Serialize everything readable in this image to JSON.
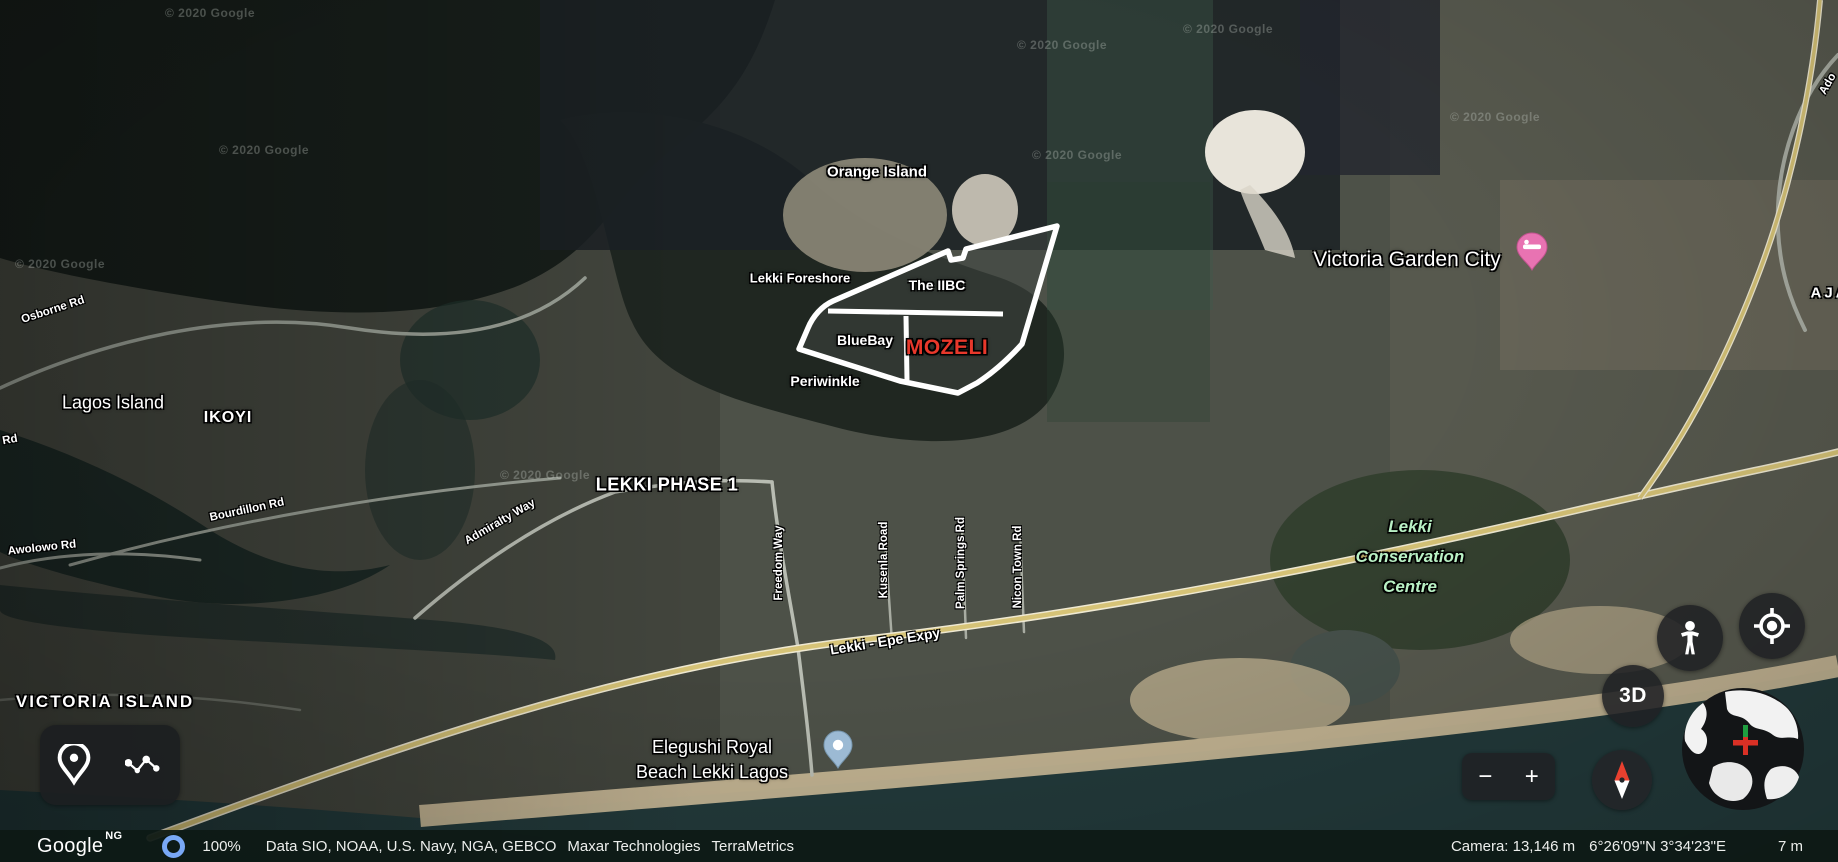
{
  "statusbar": {
    "logo": "Google",
    "region": "NG",
    "progress": "100%",
    "attribution_1": "Data SIO, NOAA, U.S. Navy, NGA, GEBCO",
    "attribution_2": "Maxar Technologies",
    "attribution_3": "TerraMetrics",
    "camera_altitude": "Camera: 13,146 m",
    "coordinates": "6°26'09\"N 3°34'23\"E",
    "elevation": "7 m"
  },
  "controls": {
    "threed_label": "3D",
    "zoom_out_label": "−",
    "zoom_in_label": "+"
  },
  "map": {
    "place_labels": [
      {
        "id": "label-orange-island",
        "text": "Orange Island",
        "x": 877,
        "y": 172,
        "size": 15,
        "weight": 600
      },
      {
        "id": "label-lekki-foreshore",
        "text": "Lekki Foreshore",
        "x": 800,
        "y": 278,
        "size": 13,
        "weight": 600
      },
      {
        "id": "label-the-iibc",
        "text": "The IIBC",
        "x": 937,
        "y": 285,
        "size": 14,
        "weight": 600
      },
      {
        "id": "label-bluebay",
        "text": "BlueBay",
        "x": 865,
        "y": 340,
        "size": 14,
        "weight": 600
      },
      {
        "id": "label-mozeli",
        "text": "MOZELI",
        "x": 947,
        "y": 348,
        "size": 21,
        "weight": 800,
        "color": "#e8382b",
        "ls": 0.5
      },
      {
        "id": "label-periwinkle",
        "text": "Periwinkle",
        "x": 825,
        "y": 381,
        "size": 14,
        "weight": 600
      },
      {
        "id": "label-lagos-island",
        "text": "Lagos Island",
        "x": 113,
        "y": 403,
        "size": 18,
        "weight": 400
      },
      {
        "id": "label-ikoyi",
        "text": "IKOYI",
        "x": 228,
        "y": 418,
        "size": 16,
        "weight": 700,
        "ls": 1
      },
      {
        "id": "label-lekki-phase-1",
        "text": "LEKKI PHASE 1",
        "x": 667,
        "y": 485,
        "size": 18,
        "weight": 700,
        "ls": 0.5
      },
      {
        "id": "label-victoria-island",
        "text": "VICTORIA ISLAND",
        "x": 105,
        "y": 702,
        "size": 17,
        "weight": 700,
        "ls": 2
      },
      {
        "id": "label-victoria-garden-city",
        "text": "Victoria Garden City",
        "x": 1407,
        "y": 260,
        "size": 21,
        "weight": 500
      },
      {
        "id": "label-lekki-conservation-centre",
        "lines": [
          "Lekki",
          "Conservation",
          "Centre"
        ],
        "x": 1410,
        "y": 557,
        "size": 17,
        "weight": 600,
        "italic": true,
        "color": "#b9f0c4",
        "lh": 30
      },
      {
        "id": "label-elegushi-royal-beach",
        "lines": [
          "Elegushi Royal",
          "Beach Lekki Lagos"
        ],
        "x": 712,
        "y": 760,
        "size": 18,
        "weight": 500,
        "lh": 25
      },
      {
        "id": "label-aja",
        "text": "AJA",
        "x": 1830,
        "y": 293,
        "size": 15,
        "weight": 700,
        "ls": 3
      }
    ],
    "road_labels": [
      {
        "id": "road-osborne-rd",
        "text": "Osborne Rd",
        "x": 53,
        "y": 310,
        "rot": -18
      },
      {
        "id": "road-rd-partial",
        "text": "Rd",
        "x": 10,
        "y": 440,
        "rot": -10
      },
      {
        "id": "road-bourdillon-rd",
        "text": "Bourdillon Rd",
        "x": 247,
        "y": 510,
        "rot": -12
      },
      {
        "id": "road-awolowo-rd",
        "text": "Awolowo Rd",
        "x": 42,
        "y": 548,
        "rot": -6
      },
      {
        "id": "road-admiralty-way",
        "text": "Admiralty Way",
        "x": 500,
        "y": 522,
        "rot": -30
      },
      {
        "id": "road-freedom-way",
        "text": "Freedom Way",
        "x": 779,
        "y": 563,
        "rot": -90
      },
      {
        "id": "road-kusenla-road",
        "text": "Kusenla Road",
        "x": 884,
        "y": 560,
        "rot": -90
      },
      {
        "id": "road-palm-springs-rd",
        "text": "Palm Springs Rd",
        "x": 961,
        "y": 563,
        "rot": -90
      },
      {
        "id": "road-nicon-town-rd",
        "text": "Nicon Town Rd",
        "x": 1018,
        "y": 567,
        "rot": -90
      },
      {
        "id": "road-lekki-epe-expy",
        "text": "Lekki - Epe Expy",
        "x": 885,
        "y": 641,
        "rot": -9,
        "size": 14
      },
      {
        "id": "road-ado",
        "text": "Ado",
        "x": 1828,
        "y": 84,
        "rot": -60
      }
    ],
    "watermarks": [
      {
        "text": "© 2020 Google",
        "x": 210,
        "y": 13
      },
      {
        "text": "© 2020 Google",
        "x": 60,
        "y": 264
      },
      {
        "text": "© 2020 Google",
        "x": 264,
        "y": 150
      },
      {
        "text": "© 2020 Google",
        "x": 1062,
        "y": 45
      },
      {
        "text": "© 2020 Google",
        "x": 1228,
        "y": 29
      },
      {
        "text": "© 2020 Google",
        "x": 1077,
        "y": 155
      },
      {
        "text": "© 2020 Google",
        "x": 545,
        "y": 475
      },
      {
        "text": "© 2020 Google",
        "x": 1495,
        "y": 117
      }
    ],
    "pins": [
      {
        "id": "lodging-pin-victoria-garden-city",
        "type": "lodging",
        "x": 1532,
        "y": 277,
        "color": "#e873b2"
      },
      {
        "id": "place-pin-elegushi-beach",
        "type": "dot",
        "x": 838,
        "y": 775,
        "color": "#9cbad4"
      }
    ],
    "colors": {
      "expressway_yellow": "#d6c377",
      "mozeli_red": "#e8382b",
      "conservation_green": "#b9f0c4",
      "progress_ring_blue": "#79a8f6",
      "pin_pink": "#e873b2",
      "pin_blue": "#9cbad4"
    }
  }
}
